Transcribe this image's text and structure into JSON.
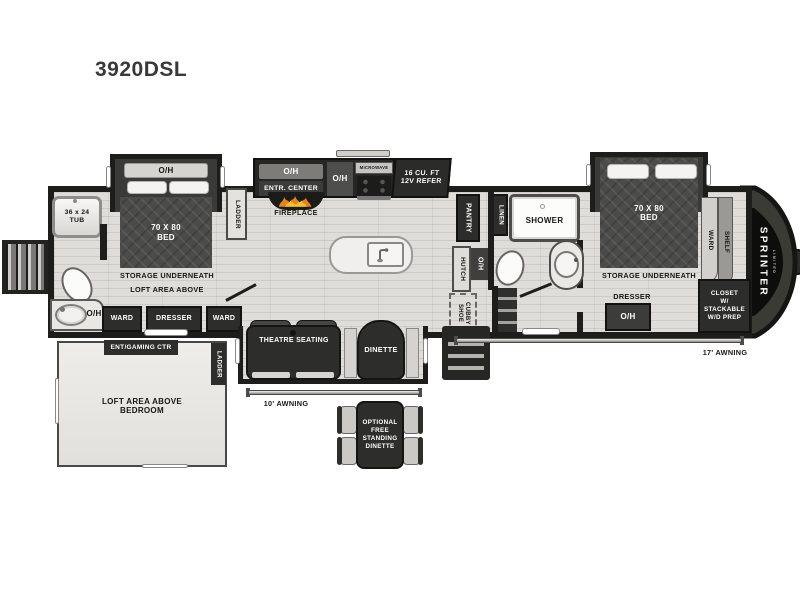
{
  "title": "3920DSL",
  "brand": {
    "name": "SPRINTER",
    "sub": "LIMITED"
  },
  "rear_bath": {
    "tub": "36 x 24\nTUB",
    "oh": "O/H"
  },
  "bedroom_front": {
    "oh": "O/H",
    "bed": "70 X 80\nBED",
    "storage": "STORAGE UNDERNEATH",
    "loft": "LOFT AREA ABOVE",
    "ward1": "WARD",
    "dresser": "DRESSER",
    "ward2": "WARD",
    "ladder": "LADDER"
  },
  "kitchen": {
    "oh1": "O/H",
    "entr_center": "ENTR. CENTER",
    "fireplace": "FIREPLACE",
    "oh2": "O/H",
    "microwave": "MICROWAVE",
    "refer": "16 CU. FT\n12V REFER"
  },
  "mid": {
    "pantry": "PANTRY",
    "hutch": "HUTCH",
    "oh": "O/H",
    "shoe_cubby": "SHOE\nCUBBY"
  },
  "bath": {
    "linen": "LINEN",
    "shower": "SHOWER"
  },
  "bedroom_master": {
    "bed": "70 X 80\nBED",
    "storage": "STORAGE UNDERNEATH",
    "ward": "WARD",
    "shelf": "SHELF",
    "dresser": "DRESSER",
    "oh": "O/H",
    "closet": "CLOSET\nW/\nSTACKABLE\nW/D PREP"
  },
  "living": {
    "theatre": "THEATRE SEATING",
    "dinette": "DINETTE"
  },
  "exterior": {
    "awning_rear": "10' AWNING",
    "awning_front": "17' AWNING"
  },
  "loft": {
    "ent": "ENT/GAMING CTR",
    "ladder": "LADDER",
    "area": "LOFT AREA ABOVE\nBEDROOM"
  },
  "optional": {
    "dinette": "OPTIONAL\nFREE\nSTANDING\nDINETTE"
  },
  "colors": {
    "wall": "#1d1d1b",
    "floor": "#dfddda",
    "dark_box": "#2d2d2b",
    "bed": "#4b4b49",
    "cap": "#3b3b36",
    "flame_orange": "#e8821c",
    "flame_yellow": "#f6c028"
  }
}
